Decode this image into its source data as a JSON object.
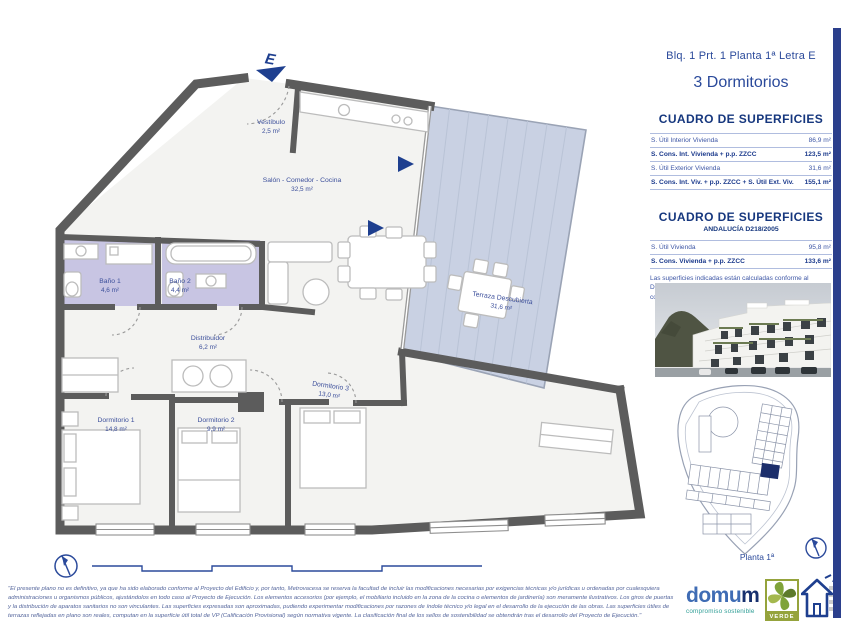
{
  "sheet": {
    "title_line": "Blq. 1 Prt. 1 Planta 1ª Letra E",
    "subtitle": "3 Dormitorios"
  },
  "surfaces_main": {
    "title": "CUADRO DE SUPERFICIES",
    "rows": [
      {
        "label": "S. Útil Interior Vivienda",
        "value": "86,9 m²",
        "bold": false
      },
      {
        "label": "S. Cons. Int. Vivienda + p.p. ZZCC",
        "value": "123,5 m²",
        "bold": true
      },
      {
        "label": "S. Útil Exterior Vivienda",
        "value": "31,6 m²",
        "bold": false
      },
      {
        "label": "S. Cons. Int. Viv. + p.p. ZZCC + S. Útil Ext. Viv.",
        "value": "155,1 m²",
        "bold": true
      }
    ]
  },
  "surfaces_andalucia": {
    "title": "CUADRO DE SUPERFICIES",
    "subtitle": "ANDALUCÍA D218/2005",
    "rows": [
      {
        "label": "S. Útil Vivienda",
        "value": "95,8 m²",
        "bold": false
      },
      {
        "label": "S. Cons. Vivienda + p.p. ZZCC",
        "value": "133,6 m²",
        "bold": true
      }
    ],
    "note": "Las superficies indicadas están calculadas conforme al Decreto 218/2005 de información al consumidor en la compraventa y arrendamiento de viviendas en Andalucía."
  },
  "floor_plan": {
    "entrance_label": "E",
    "rooms": [
      {
        "name": "Vestíbulo",
        "area": "2,5 m²"
      },
      {
        "name": "Salón - Comedor - Cocina",
        "area": "32,5 m²"
      },
      {
        "name": "Baño 1",
        "area": "4,6 m²"
      },
      {
        "name": "Baño 2",
        "area": "4,4 m²"
      },
      {
        "name": "Distribuidor",
        "area": "6,2 m²"
      },
      {
        "name": "Dormitorio 1",
        "area": "14,8 m²"
      },
      {
        "name": "Dormitorio 2",
        "area": "9,9 m²"
      },
      {
        "name": "Dormitorio 3",
        "area": "13,0 m²"
      },
      {
        "name": "Terraza Descubierta",
        "area": "31,6 m²"
      }
    ]
  },
  "site_plan": {
    "caption": "Planta 1ª"
  },
  "footer": {
    "legal_text": "\"El presente plano no es definitivo, ya que ha sido elaborado conforme al Proyecto del Edificio y, por tanto, Metrovacesa se reserva la facultad de incluir las modificaciones necesarias por exigencias técnicas y/o jurídicas u ordenadas por cualesquiera administraciones u organismos públicos, ajustándolos en todo caso al Proyecto de Ejecución. Los elementos accesorios (por ejemplo, el mobiliario incluido en la zona de la cocina o elementos de jardinería) son meramente ilustrativos. Los giros de puertas y la distribución de aparatos sanitarios no son vinculantes. Las superficies expresadas son aproximadas, pudiendo experimentar modificaciones por razones de índole técnico y/o legal en el desarrollo de la ejecución de las obras. Las superficies útiles de terrazas reflejadas en plano son reales, computan en la superficie útil total de VP (Calificación Provisional) según normativa vigente. La clasificación final de los sellos de sostenibilidad se obtendrán tras el desarrollo del Proyecto de Ejecución.\"",
    "domum": {
      "text_main": "domu",
      "text_last": "m",
      "tagline": "compromiso sostenible"
    },
    "verde_label": "VERDE",
    "energy_label": "A"
  },
  "colors": {
    "accent_blue": "#2b4a9b",
    "title_blue": "#16377e",
    "wall_gray": "#5c5c5c",
    "bathroom_fill": "#c8c5e3",
    "terrace_fill": "#c9d1e3",
    "highlight_navy": "#1c2e6b",
    "verde_green": "#95a33c",
    "domum_teal": "#2f9e96"
  }
}
